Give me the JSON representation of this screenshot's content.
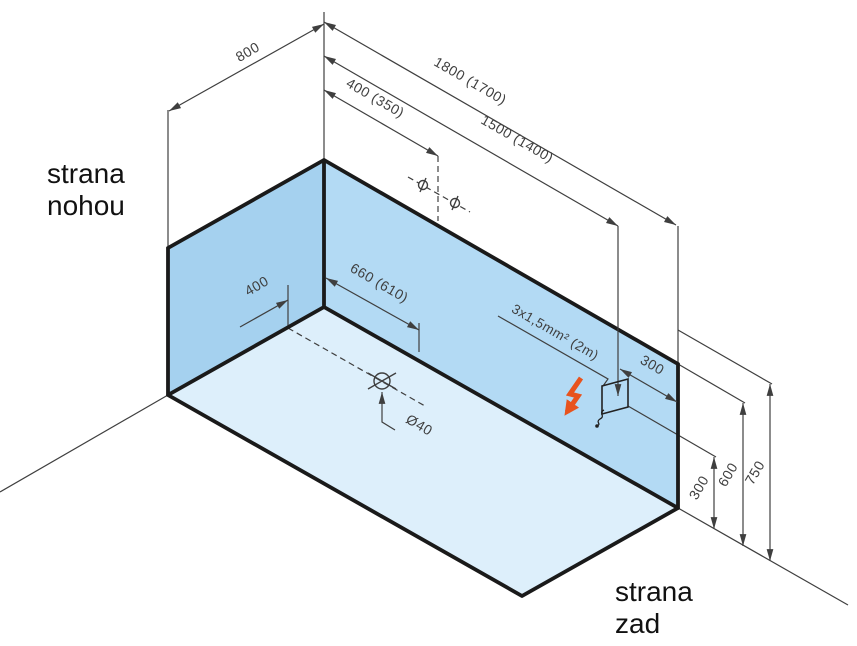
{
  "labels": {
    "foot_side_line1": "strana",
    "foot_side_line2": "nohou",
    "back_side_line1": "strana",
    "back_side_line2": "zad"
  },
  "dimensions": {
    "depth": "800",
    "length_total": "1800 (1700)",
    "length_to_outlet": "1500 (1400)",
    "water_connection_offset": "400 (350)",
    "drain_from_foot_wall": "400",
    "drain_along_back_wall": "660 (610)",
    "drain_diameter": "Ø40",
    "cable_spec": "3x1,5mm² (2m)",
    "outlet_from_edge": "300",
    "height_outlet": "300",
    "height_rim": "600",
    "height_zone": "750"
  },
  "icons": {
    "drain": "drain-symbol",
    "water_points": "water-connection-point",
    "electric": "lightning-bolt",
    "outlet": "outlet-box",
    "cable": "cable-squiggle"
  },
  "colors": {
    "wall_left": "#a5d1ef",
    "wall_back": "#b3daf4",
    "floor": "#ddeffb",
    "bolt": "#e8531d",
    "edge": "#1a1a1a",
    "line": "#3f3f3f",
    "text": "#111111",
    "bg": "#ffffff"
  }
}
